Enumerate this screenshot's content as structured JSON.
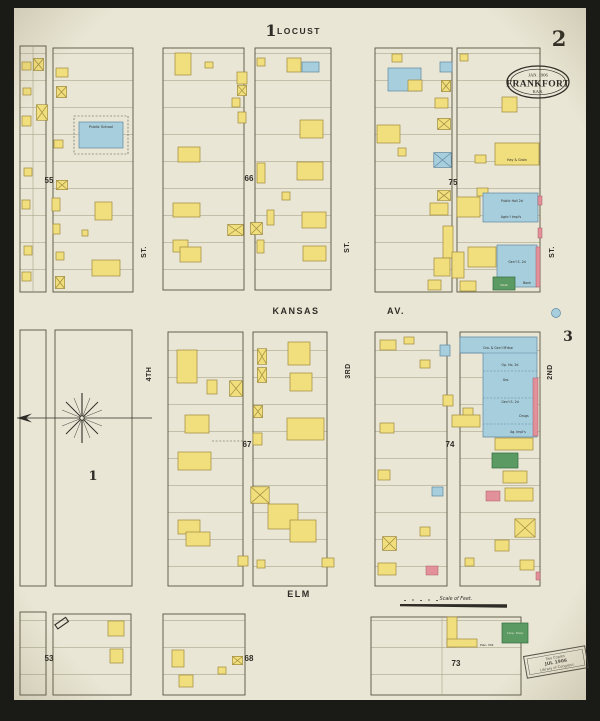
{
  "palette": {
    "bg": "#1a1a17",
    "paper": "#e9e6d5",
    "ink": "#2e2c26",
    "line": "#57533f",
    "lotline": "#aaa489",
    "yellow": "#f1de7d",
    "yellow_line": "#9f8c3f",
    "blue": "#a7cedd",
    "blue_line": "#5f88a2",
    "green": "#5b9a63",
    "green_line": "#316b3e",
    "pink": "#e2909a",
    "pink_line": "#ad5a67",
    "stamp_ink": "#3c3931"
  },
  "sheet": {
    "top_ref": "1",
    "number": "2",
    "side_ref": "3",
    "scale_label": "Scale of Feet."
  },
  "stamp": {
    "date": "JAN. 1906",
    "city": "FRANKFORT",
    "state": "KAN."
  },
  "loc_stamp": {
    "l1": "Two Copies",
    "l2": "JUL 1906",
    "l3": "Library of Congress"
  },
  "streets": {
    "locust": "LOCUST",
    "kansas": "KANSAS",
    "kansas_suffix": "AV.",
    "elm": "ELM",
    "st_a": "ST.",
    "st_b": "ST.",
    "st_c": "ST.",
    "fourth": "4TH",
    "third": "3RD",
    "second": "2ND"
  },
  "blocks": {
    "b55": "55",
    "b66": "66",
    "b75": "75",
    "b67": "67",
    "b74": "74",
    "b53": "53",
    "b68": "68",
    "b73": "73",
    "open_block": "1"
  },
  "buildings": {
    "public_school": "Public School",
    "hay_grain": "Hay & Grain",
    "public_hall": "Public Hall 2d",
    "agric_impls": "Agric'l Impl's",
    "genl_store": "Gen'l S. 2d",
    "bank": "Bank",
    "meat": "Meat",
    "gro_gen": "Gro. & Gen'l M'dse",
    "op_house": "Op. Ho. 2d",
    "gro": "Gro.",
    "genl_store2": "Gen'l S. 2d",
    "drugs": "Drugs",
    "ag_impls": "Ag. Impl's",
    "plan_mill": "Plan. Mill",
    "carp_shop": "Carp. Shop"
  }
}
